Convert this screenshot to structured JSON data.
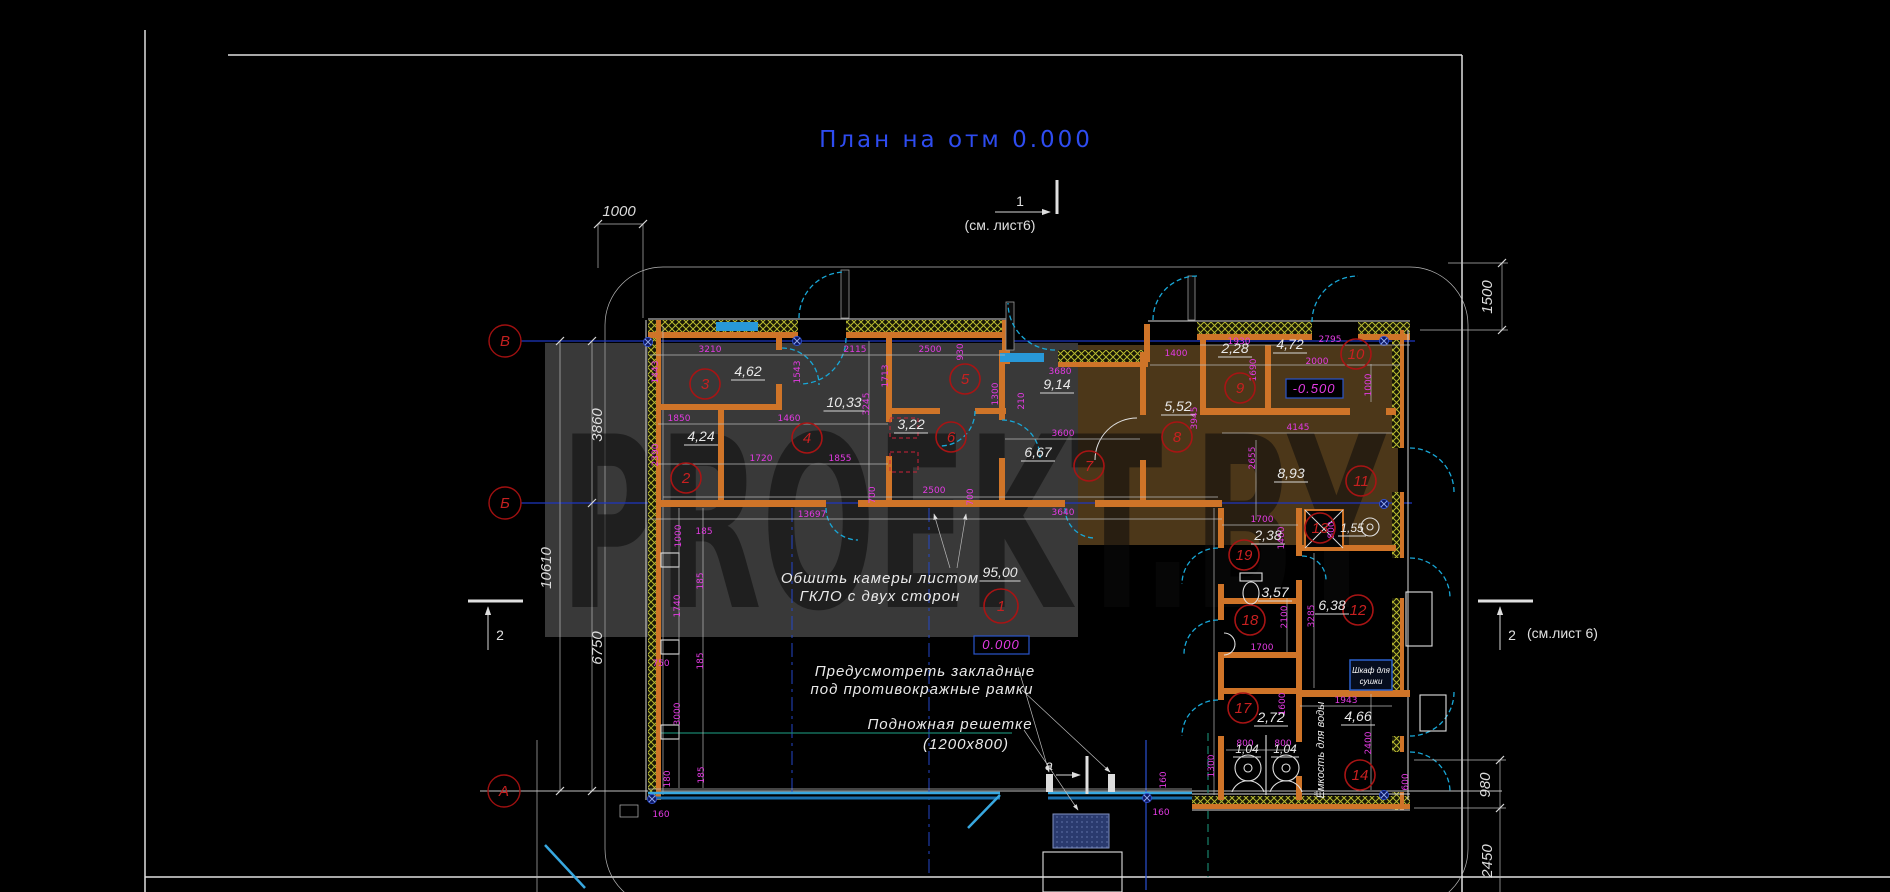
{
  "title": "План на отм 0.000",
  "watermark": "PROEKT.BY",
  "colors": {
    "background": "#000000",
    "title_blue": "#2e4cf0",
    "dim_magenta": "#e23ae2",
    "wall_orange": "#cf7428",
    "hatch_yellow": "#b8ba30",
    "room_red": "#c82020",
    "door_cyan": "#18a8d8",
    "axis_blue": "#1e36c0",
    "storefront_cyan": "#38a8e0",
    "teal": "#18836c",
    "fill_brown": "#7a5828",
    "watermark_gray": "#969696"
  },
  "axes": [
    {
      "label": "В",
      "x": 505,
      "y": 341
    },
    {
      "label": "Б",
      "x": 505,
      "y": 503
    },
    {
      "label": "А",
      "x": 504,
      "y": 791
    }
  ],
  "section_markers": {
    "top": {
      "num": "1",
      "note": "(см. лист6)"
    },
    "left": {
      "num": "2",
      "note": ""
    },
    "right": {
      "num": "2",
      "note": "(см.лист 6)"
    },
    "bottom": {
      "num": "а",
      "note": ""
    }
  },
  "elevation_marks": [
    {
      "text": "-0.500",
      "x": 1314,
      "y": 393
    },
    {
      "text": "0.000",
      "x": 1001,
      "y": 649
    }
  ],
  "notes": {
    "sheathing": [
      "Обшить камеры листом",
      "ГКЛО с двух сторон"
    ],
    "embedded": [
      "Предусмотреть закладные",
      "под противокражные рамки"
    ],
    "grate": [
      "Подножная решетке",
      "(1200х800)"
    ]
  },
  "equipment": {
    "cabinet_line1": "Шкаф для",
    "cabinet_line2": "сушки",
    "tank": "Ёмкость для воды"
  },
  "rooms": [
    {
      "num": "1",
      "x": 1001,
      "y": 606,
      "area": "95,00",
      "ax": 1000,
      "ay": 577
    },
    {
      "num": "2",
      "x": 686,
      "y": 478,
      "area": "4,24",
      "ax": 701,
      "ay": 441
    },
    {
      "num": "3",
      "x": 705,
      "y": 384,
      "area": "4,62",
      "ax": 748,
      "ay": 376
    },
    {
      "num": "4",
      "x": 807,
      "y": 438,
      "area": "10,33",
      "ax": 844,
      "ay": 407
    },
    {
      "num": "5",
      "x": 965,
      "y": 379,
      "area": "9,14",
      "ax": 1057,
      "ay": 389
    },
    {
      "num": "6",
      "x": 951,
      "y": 437,
      "area": "3,22",
      "ax": 911,
      "ay": 429
    },
    {
      "num": "7",
      "x": 1089,
      "y": 466,
      "area": "6,67",
      "ax": 1038,
      "ay": 457
    },
    {
      "num": "8",
      "x": 1177,
      "y": 437,
      "area": "5,52",
      "ax": 1178,
      "ay": 411
    },
    {
      "num": "9",
      "x": 1240,
      "y": 388,
      "area": "2,28",
      "ax": 1235,
      "ay": 353
    },
    {
      "num": "10",
      "x": 1356,
      "y": 354,
      "area": "4,72",
      "ax": 1290,
      "ay": 349
    },
    {
      "num": "11",
      "x": 1361,
      "y": 481,
      "area": "8,93",
      "ax": 1291,
      "ay": 478
    },
    {
      "num": "12",
      "x": 1358,
      "y": 610,
      "area": "6,38",
      "ax": 1332,
      "ay": 610
    },
    {
      "num": "13",
      "x": 1320,
      "y": 528,
      "area": "",
      "ax": 0,
      "ay": 0
    },
    {
      "num": "14",
      "x": 1360,
      "y": 775,
      "area": "4,66",
      "ax": 1358,
      "ay": 721
    },
    {
      "num": "17",
      "x": 1243,
      "y": 708,
      "area": "2,72",
      "ax": 1271,
      "ay": 722
    },
    {
      "num": "18",
      "x": 1250,
      "y": 620,
      "area": "3,57",
      "ax": 1275,
      "ay": 597
    },
    {
      "num": "19",
      "x": 1244,
      "y": 555,
      "area": "2,38",
      "ax": 1268,
      "ay": 540
    }
  ],
  "small_areas": [
    {
      "text": "1,04",
      "x": 1247,
      "y": 753
    },
    {
      "text": "1,04",
      "x": 1285,
      "y": 753
    },
    {
      "text": "1,55",
      "x": 1352,
      "y": 532
    }
  ],
  "dims_large": [
    {
      "text": "1000",
      "x": 619,
      "y": 216,
      "rot": 0
    },
    {
      "text": "3860",
      "x": 602,
      "y": 425,
      "rot": -90
    },
    {
      "text": "10610",
      "x": 551,
      "y": 568,
      "rot": -90
    },
    {
      "text": "6750",
      "x": 602,
      "y": 648,
      "rot": -90
    },
    {
      "text": "1500",
      "x": 1492,
      "y": 297,
      "rot": -90
    },
    {
      "text": "980",
      "x": 1490,
      "y": 785,
      "rot": -90
    },
    {
      "text": "2450",
      "x": 1492,
      "y": 861,
      "rot": -90
    }
  ],
  "dims_small": [
    {
      "text": "3210",
      "x": 710,
      "y": 352,
      "rot": 0
    },
    {
      "text": "2115",
      "x": 855,
      "y": 352,
      "rot": 0
    },
    {
      "text": "2500",
      "x": 930,
      "y": 352,
      "rot": 0
    },
    {
      "text": "1400",
      "x": 1176,
      "y": 356,
      "rot": 0
    },
    {
      "text": "1930",
      "x": 1239,
      "y": 344,
      "rot": 0
    },
    {
      "text": "2795",
      "x": 1330,
      "y": 342,
      "rot": 0
    },
    {
      "text": "1443",
      "x": 658,
      "y": 372,
      "rot": -90
    },
    {
      "text": "1543",
      "x": 800,
      "y": 372,
      "rot": -90
    },
    {
      "text": "930",
      "x": 963,
      "y": 352,
      "rot": -90
    },
    {
      "text": "1713",
      "x": 888,
      "y": 376,
      "rot": -90
    },
    {
      "text": "1690",
      "x": 1256,
      "y": 370,
      "rot": -90
    },
    {
      "text": "1000",
      "x": 1371,
      "y": 385,
      "rot": -90
    },
    {
      "text": "1850",
      "x": 679,
      "y": 421,
      "rot": 0
    },
    {
      "text": "1460",
      "x": 789,
      "y": 421,
      "rot": 0
    },
    {
      "text": "3680",
      "x": 1060,
      "y": 374,
      "rot": 0
    },
    {
      "text": "2000",
      "x": 1317,
      "y": 364,
      "rot": 0
    },
    {
      "text": "3245",
      "x": 869,
      "y": 404,
      "rot": -90
    },
    {
      "text": "1300",
      "x": 998,
      "y": 394,
      "rot": -90
    },
    {
      "text": "210",
      "x": 1024,
      "y": 401,
      "rot": -90
    },
    {
      "text": "3945",
      "x": 1197,
      "y": 418,
      "rot": -90
    },
    {
      "text": "1720",
      "x": 761,
      "y": 461,
      "rot": 0
    },
    {
      "text": "1855",
      "x": 840,
      "y": 461,
      "rot": 0
    },
    {
      "text": "3600",
      "x": 1063,
      "y": 436,
      "rot": 0
    },
    {
      "text": "4145",
      "x": 1298,
      "y": 430,
      "rot": 0
    },
    {
      "text": "2390",
      "x": 658,
      "y": 455,
      "rot": -90
    },
    {
      "text": "700",
      "x": 875,
      "y": 495,
      "rot": -90
    },
    {
      "text": "2500",
      "x": 934,
      "y": 493,
      "rot": 0
    },
    {
      "text": "700",
      "x": 973,
      "y": 497,
      "rot": -90
    },
    {
      "text": "3640",
      "x": 1063,
      "y": 515,
      "rot": 0
    },
    {
      "text": "13697",
      "x": 812,
      "y": 517,
      "rot": 0
    },
    {
      "text": "2655",
      "x": 1255,
      "y": 458,
      "rot": -90
    },
    {
      "text": "1700",
      "x": 1262,
      "y": 522,
      "rot": 0
    },
    {
      "text": "1400",
      "x": 1284,
      "y": 538,
      "rot": -90
    },
    {
      "text": "800",
      "x": 1334,
      "y": 530,
      "rot": -90
    },
    {
      "text": "1000",
      "x": 681,
      "y": 536,
      "rot": -90
    },
    {
      "text": "185",
      "x": 704,
      "y": 534,
      "rot": 0
    },
    {
      "text": "185",
      "x": 703,
      "y": 581,
      "rot": -90
    },
    {
      "text": "1740",
      "x": 680,
      "y": 606,
      "rot": -90
    },
    {
      "text": "750",
      "x": 661,
      "y": 666,
      "rot": 0
    },
    {
      "text": "185",
      "x": 703,
      "y": 661,
      "rot": -90
    },
    {
      "text": "3000",
      "x": 680,
      "y": 714,
      "rot": -90
    },
    {
      "text": "2100",
      "x": 1287,
      "y": 617,
      "rot": -90
    },
    {
      "text": "3285",
      "x": 1314,
      "y": 616,
      "rot": -90
    },
    {
      "text": "1700",
      "x": 1262,
      "y": 650,
      "rot": 0
    },
    {
      "text": "1600",
      "x": 1285,
      "y": 704,
      "rot": -90
    },
    {
      "text": "1943",
      "x": 1346,
      "y": 703,
      "rot": 0
    },
    {
      "text": "800",
      "x": 1245,
      "y": 746,
      "rot": 0
    },
    {
      "text": "800",
      "x": 1283,
      "y": 746,
      "rot": 0
    },
    {
      "text": "1300",
      "x": 1214,
      "y": 766,
      "rot": -90
    },
    {
      "text": "2400",
      "x": 1371,
      "y": 743,
      "rot": -90
    },
    {
      "text": "600",
      "x": 1408,
      "y": 782,
      "rot": -90
    },
    {
      "text": "180",
      "x": 670,
      "y": 779,
      "rot": -90
    },
    {
      "text": "185",
      "x": 704,
      "y": 775,
      "rot": -90
    },
    {
      "text": "160",
      "x": 661,
      "y": 817,
      "rot": 0
    },
    {
      "text": "160",
      "x": 1166,
      "y": 780,
      "rot": -90
    },
    {
      "text": "160",
      "x": 1161,
      "y": 815,
      "rot": 0
    }
  ]
}
